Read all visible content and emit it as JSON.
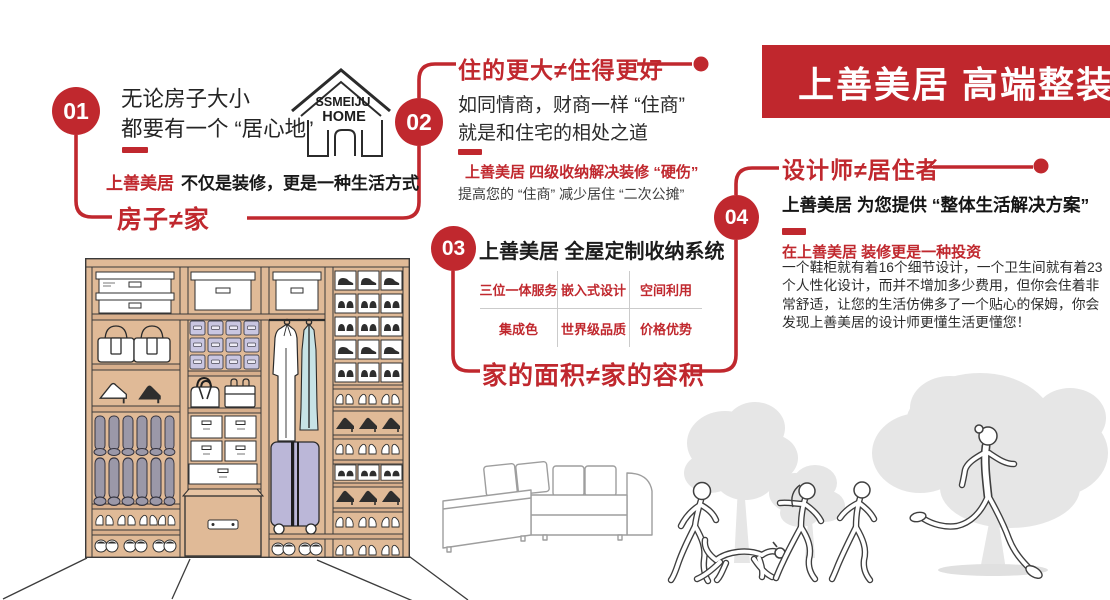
{
  "banner": {
    "title": "上善美居 高端整装"
  },
  "logo": {
    "line1": "SSMEIJU",
    "line2": "HOME"
  },
  "steps": {
    "s1": {
      "number": "01",
      "intro_line1": "无论房子大小",
      "intro_line2": "都要有一个 “居心地”",
      "slogan_brand": "上善美居",
      "slogan_rest": "不仅是装修，更是一种生活方式",
      "tagline": "房子≠家"
    },
    "s2": {
      "number": "02",
      "heading": "住的更大≠住得更好",
      "body_line1": "如同情商，财商一样 “住商”",
      "body_line2": "就是和住宅的相处之道",
      "sub_red": "上善美居 四级收纳解决装修 “硬伤”",
      "sub_gray": "提高您的 “住商” 减少居住 “二次公摊”"
    },
    "s3": {
      "number": "03",
      "title": "上善美居 全屋定制收纳系统",
      "table": {
        "row1": [
          "三位一体服务",
          "嵌入式设计",
          "空间利用"
        ],
        "row2": [
          "集成色",
          "世界级品质",
          "价格优势"
        ]
      },
      "tagline": "家的面积≠家的容积"
    },
    "s4": {
      "number": "04",
      "heading": "设计师≠居住者",
      "line1": "上善美居 为您提供 “整体生活解决方案”",
      "sub_red": "在上善美居 装修更是一种投资",
      "paragraph": "一个鞋柜就有着16个细节设计，一个卫生间就有着23个人性化设计，而并不增加多少费用，但你会住着非常舒适，让您的生活仿佛多了一个贴心的保姆，你会发现上善美居的设计师更懂生活更懂您！"
    }
  },
  "colors": {
    "accent_red": "#C0282E",
    "banner_red": "#C0272D",
    "wardrobe_tan": "#E0BA97",
    "bin_lavender": "#C9C6E1",
    "boot_gray": "#9B98A8",
    "suitcase_lavender": "#BBB7D8",
    "garment_blue": "#C7E3E6",
    "silhouette_gray": "#E6E6E6"
  },
  "illustrations": {
    "logo": "house-outline-logo",
    "wardrobe": "wardrobe-closet-line-art",
    "sofa": "sectional-sofa-line-art",
    "scene": "family-running-with-dog-and-trees"
  }
}
